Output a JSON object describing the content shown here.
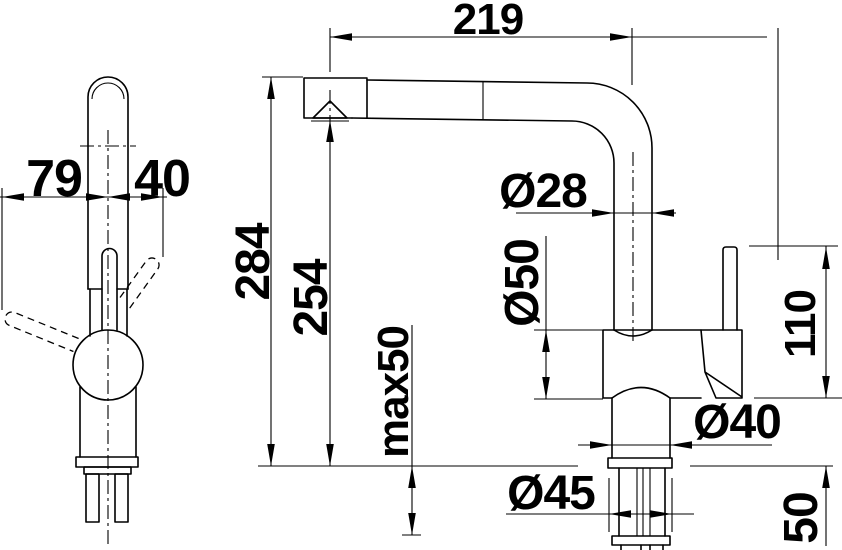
{
  "drawing": {
    "title": "faucet-dimension-drawing",
    "background_color": "#ffffff",
    "line_color": "#000000",
    "views": {
      "left": "side view",
      "right": "front view"
    },
    "dims": {
      "d79": "79",
      "d40": "40",
      "d219": "219",
      "d284": "284",
      "d254": "254",
      "dmax50": "max50",
      "d28": "Ø28",
      "d50body": "Ø50",
      "d40neck": "Ø40",
      "d45": "Ø45",
      "d110": "110",
      "d50shank": "50"
    }
  }
}
